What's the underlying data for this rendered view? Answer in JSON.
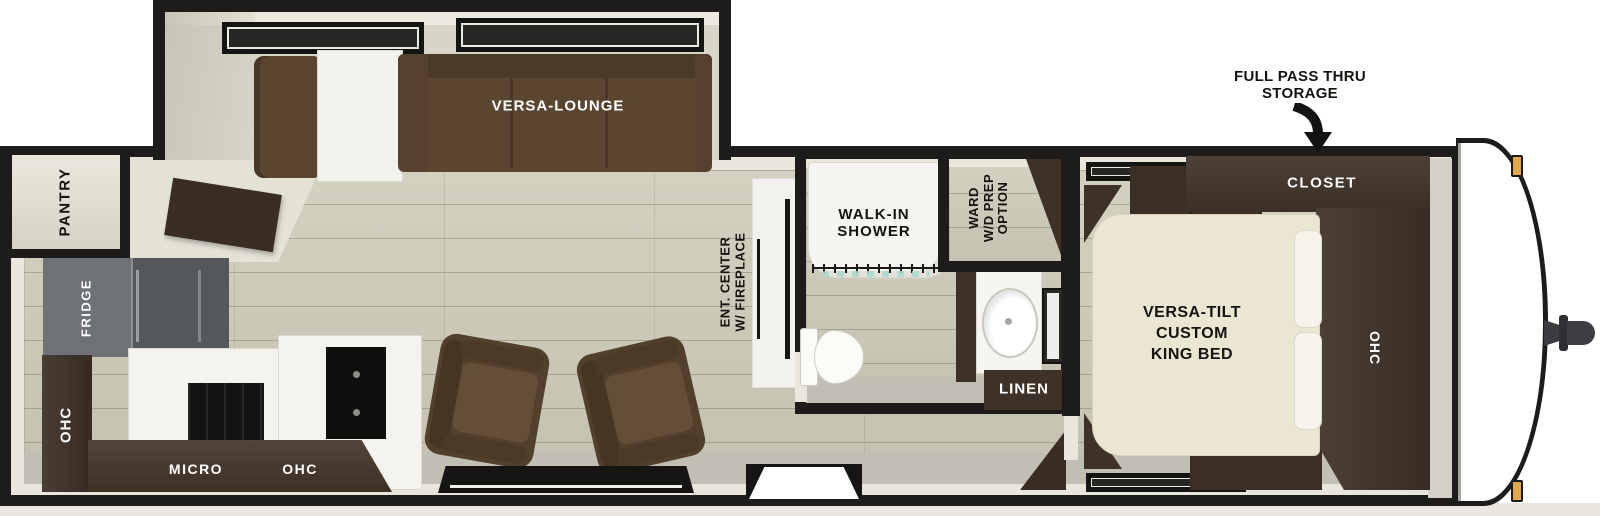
{
  "annotation": {
    "storage_line1": "FULL PASS THRU",
    "storage_line2": "STORAGE",
    "arrow_icon": "curved-down-arrow"
  },
  "slideout": {
    "lounge_label": "VERSA-LOUNGE"
  },
  "kitchen": {
    "pantry_label": "PANTRY",
    "fridge_label": "FRIDGE",
    "ohc_side_label": "OHC",
    "micro_label": "MICRO",
    "ohc_overhead_label": "OHC"
  },
  "living": {
    "ent_center_line1": "ENT. CENTER",
    "ent_center_line2": "W/ FIREPLACE"
  },
  "bathroom": {
    "shower_line1": "WALK-IN",
    "shower_line2": "SHOWER",
    "linen_label": "LINEN"
  },
  "wardrobe": {
    "line1": "WARD",
    "line2": "W/D PREP",
    "line3": "OPTION"
  },
  "bedroom": {
    "bed_line1": "VERSA-TILT",
    "bed_line2": "CUSTOM",
    "bed_line3": "KING BED",
    "closet_label": "CLOSET",
    "ohc_label": "OHC"
  },
  "colors": {
    "wall": "#1d1c1a",
    "lining": "#e9e6db",
    "floor": "#cfccba",
    "walkway": "#c1beb4",
    "wood": "#3e3127",
    "sofa": "#5a4531",
    "bed": "#eae6d1",
    "amber": "#e2a94a",
    "teal": "#a8d8cf",
    "fridge": "#6e7175",
    "counter": "#f4f3ee"
  }
}
